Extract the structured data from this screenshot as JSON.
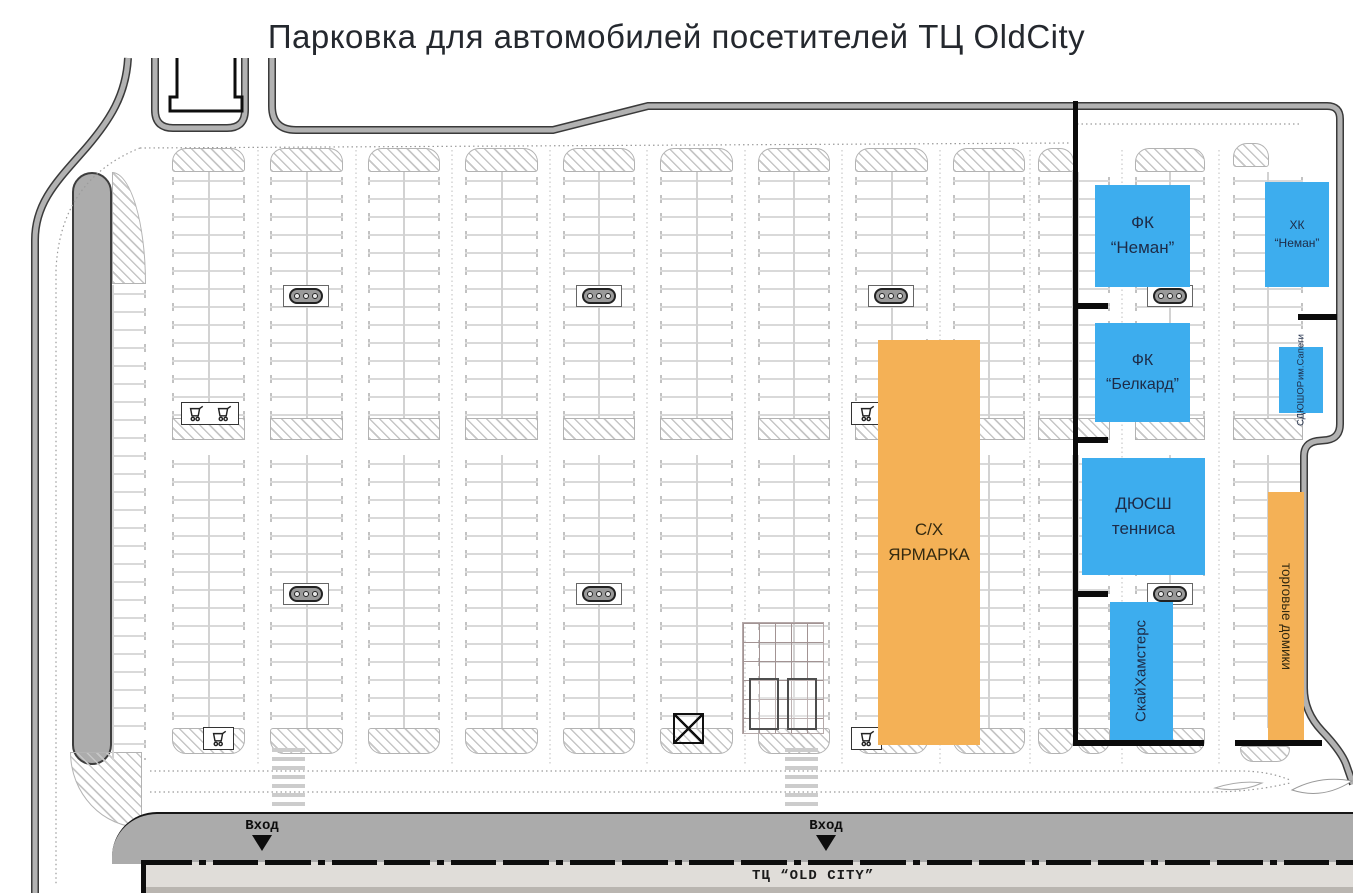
{
  "page": {
    "title": "Парковка для автомобилей посетителей ТЦ OldCity"
  },
  "venues": {
    "fk_neman": {
      "line1": "ФК",
      "line2": "“Неман”"
    },
    "hk_neman": {
      "line1": "ХК",
      "line2": "“Неман”"
    },
    "fk_belkard": {
      "line1": "ФК",
      "line2": "“Белкард”"
    },
    "sdushor_sapegi": {
      "line1": "СДЮШОР",
      "line2": "им.Сапеги"
    },
    "dussh_tennis": {
      "line1": "ДЮСШ",
      "line2": "тенниса"
    },
    "sky_hamsters": {
      "line1": "Скай",
      "line2": "Хамстерс"
    },
    "agri_fair": {
      "line1": "С/Х",
      "line2": "ЯРМАРКА"
    },
    "trade_houses": {
      "text": "торговые домики"
    }
  },
  "road": {
    "entrance_label": "Вход",
    "building_label": "ТЦ “OLD CITY”"
  },
  "colors": {
    "venue_blue": "#3dadee",
    "venue_orange": "#f4b156",
    "road_gray": "#ababab",
    "building_gray": "#e0ddd9",
    "boundary_black": "#0b0b0b"
  }
}
